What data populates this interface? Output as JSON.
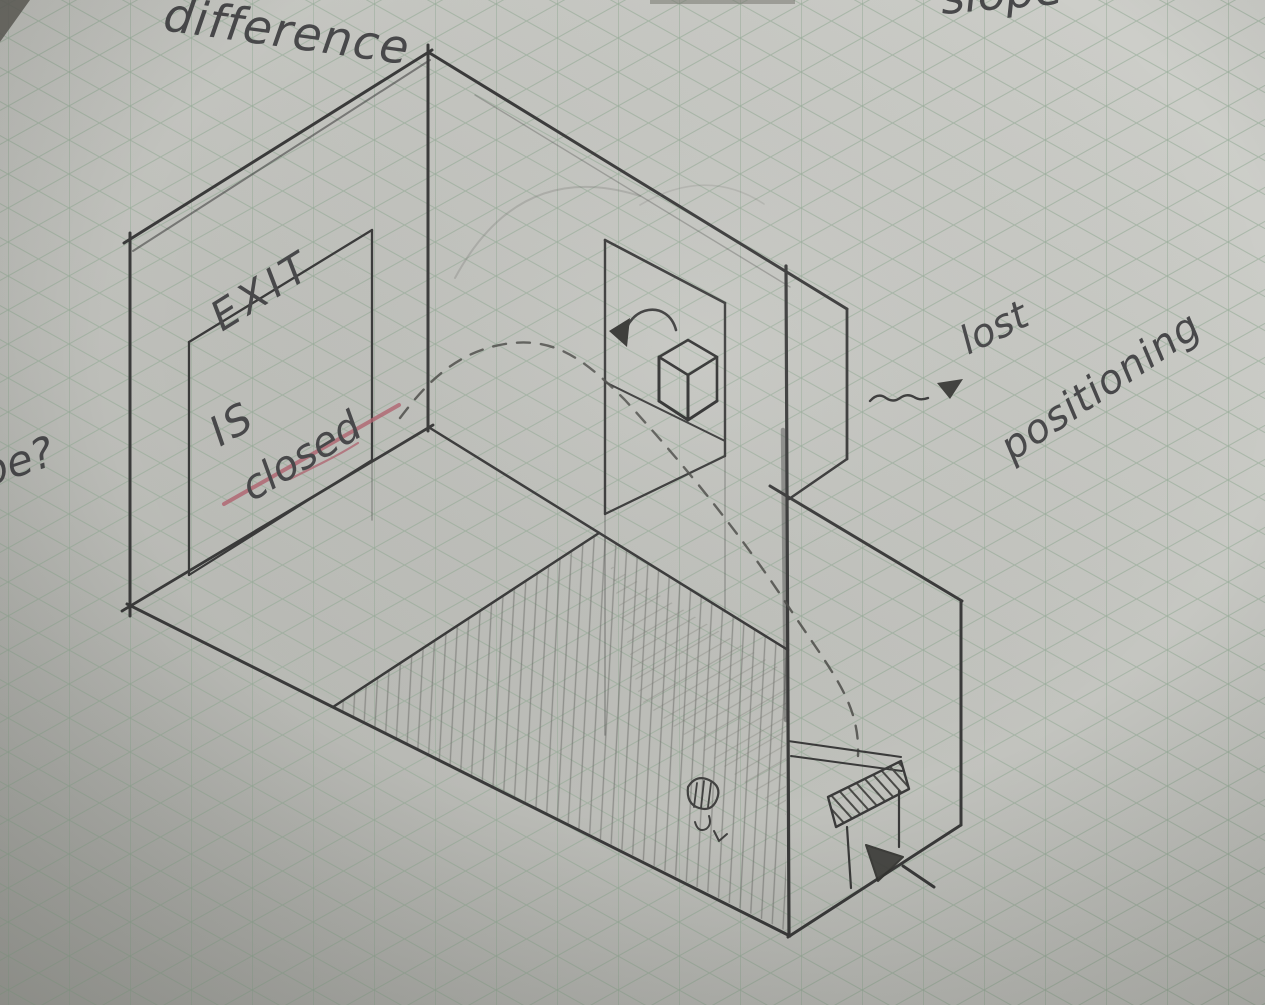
{
  "scene": {
    "description": "Pencil sketch of an isometric room layout drawn on green isometric graph paper",
    "subject": "isometric level-design sketch with EXIT sign room, window with rotating cube, hatched ramp floor and lower room with marked block"
  },
  "sign": {
    "line1": "EXIT",
    "line2": "IS",
    "line3": "closed"
  },
  "annotations": {
    "top_label": "difference",
    "top_right_partial_label": "slope",
    "left_margin_partial_label": "be?",
    "left_margin_letter_fragment": "n",
    "arrow_label_line1": "lost",
    "arrow_label_line2": "positioning"
  },
  "colors": {
    "paper_light": "#cdcec9",
    "paper_mid": "#bfc0bb",
    "paper_shadow": "#9b9c97",
    "grid_green": "#92a994",
    "pencil_dark": "#3a3a3a",
    "pencil_mid": "#5c5c59",
    "pencil_light": "#8b8b87",
    "red_underline": "#b2636f",
    "handwriting": "#48484a"
  }
}
